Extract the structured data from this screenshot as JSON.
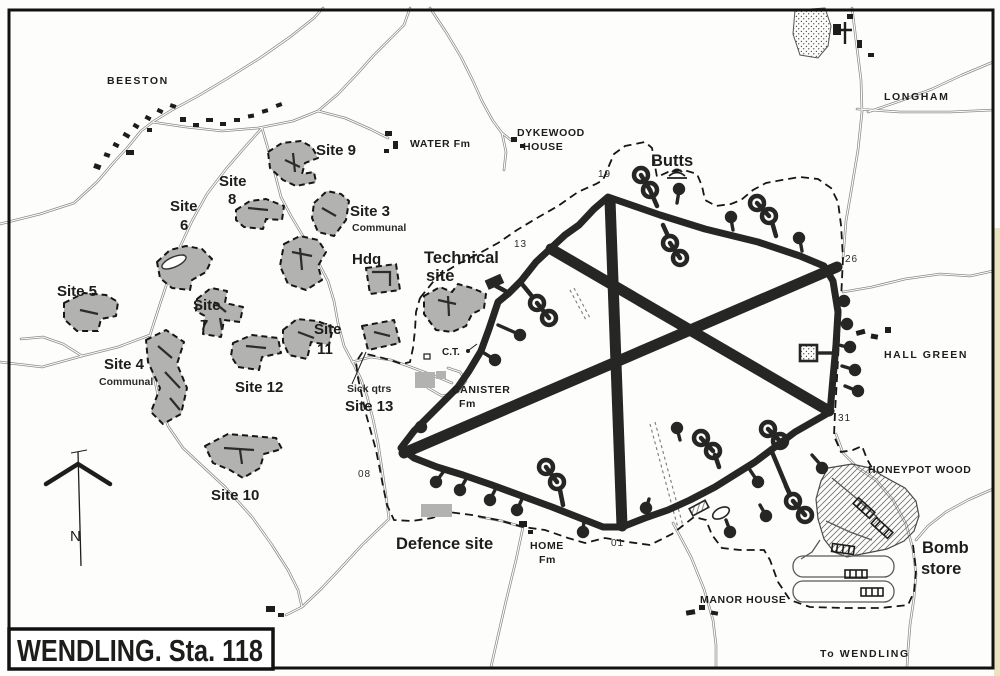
{
  "map": {
    "title": "WENDLING. Sta. 118",
    "compass": "N",
    "places": {
      "beeston": "BEESTON",
      "water_fm": "WATER Fm",
      "dykewood_line1": "DYKEWOOD",
      "dykewood_line2": "HOUSE",
      "longham": "LONGHAM",
      "hall_green": "HALL GREEN",
      "honeypot_wood": "HONEYPOT WOOD",
      "manor_house": "MANOR HOUSE",
      "home_fm_line1": "HOME",
      "home_fm_line2": "Fm",
      "canister_fm_line1": "CANISTER",
      "canister_fm_line2": "Fm",
      "to_wendling": "To WENDLING",
      "control_tower": "C.T."
    },
    "airfield": {
      "butts": "Butts",
      "technical_site_line1": "Technical",
      "technical_site_line2": "site",
      "defence_site": "Defence site",
      "bomb_store_line1": "Bomb",
      "bomb_store_line2": "store",
      "headings": {
        "r01": "01",
        "r08": "08",
        "r13": "13",
        "r19": "19",
        "r26": "26",
        "r31": "31"
      }
    },
    "sites": {
      "site3": "Site 3",
      "site3_sub": "Communal",
      "site4": "Site 4",
      "site4_sub": "Communal",
      "site5": "Site 5",
      "site6_line1": "Site",
      "site6_line2": "6",
      "site7_line1": "Site",
      "site7_line2": "7",
      "site8_line1": "Site",
      "site8_line2": "8",
      "site9": "Site 9",
      "site10": "Site 10",
      "site11_line1": "Site",
      "site11_line2": "11",
      "site12": "Site 12",
      "site13": "Site 13",
      "sick_qtrs": "Sick qtrs",
      "hdq": "Hdq"
    },
    "colors": {
      "ink": "#1d1d1b",
      "site_fill": "#b2b2b0",
      "road": "#8a8a88",
      "paper": "#fdfdfc"
    }
  }
}
